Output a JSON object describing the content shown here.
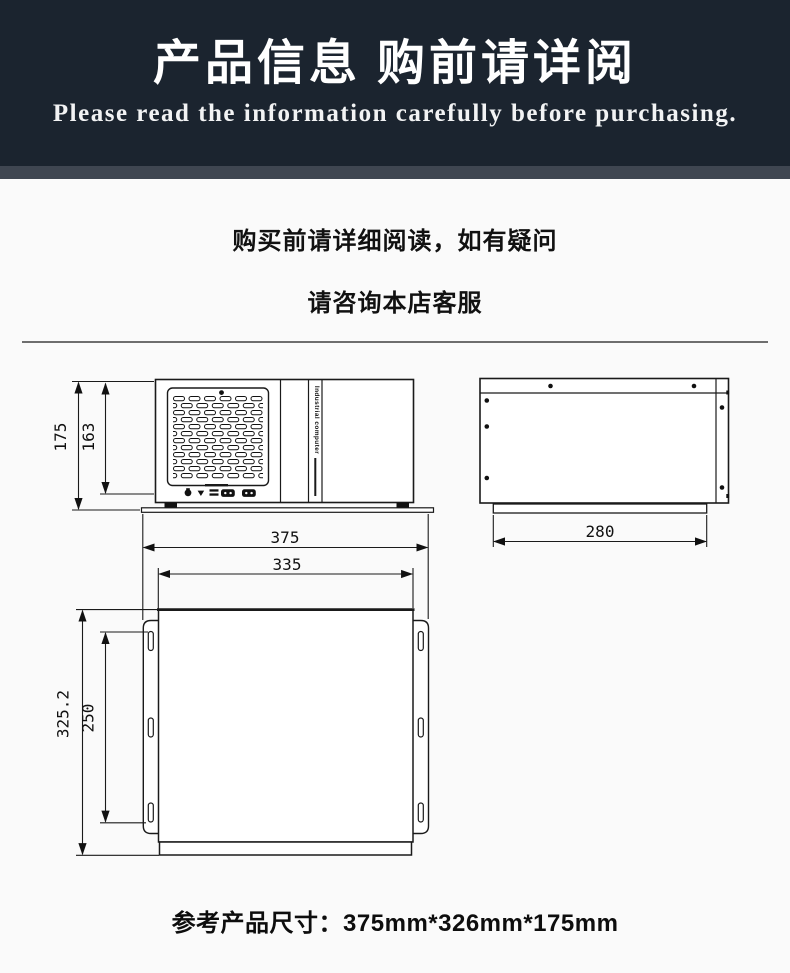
{
  "header": {
    "title": "产品信息 购前请详阅",
    "subtitle": "Please read the information carefully before purchasing."
  },
  "notice": {
    "line1": "购买前请详细阅读，如有疑问",
    "line2": "请咨询本店客服"
  },
  "drawing": {
    "front_view": {
      "side_label": "Industrial computer",
      "dim_height_outer": "175",
      "dim_height_inner": "163",
      "icons": [
        "knob-icon",
        "power-triangle-icon",
        "vent-bars-icon",
        "serial-port-icon",
        "serial-port-icon"
      ]
    },
    "side_view": {
      "dim_depth": "280"
    },
    "top_view": {
      "dim_width_outer": "375",
      "dim_width_inner": "335",
      "dim_depth_outer": "325.2",
      "dim_depth_inner": "250"
    }
  },
  "footer": {
    "size_text": "参考产品尺寸：375mm*326mm*175mm"
  },
  "colors": {
    "banner_bg": "#1b242f",
    "banner_strip": "#3f4651",
    "page_bg": "#fafafa",
    "line_ink": "#1a1a1a"
  }
}
